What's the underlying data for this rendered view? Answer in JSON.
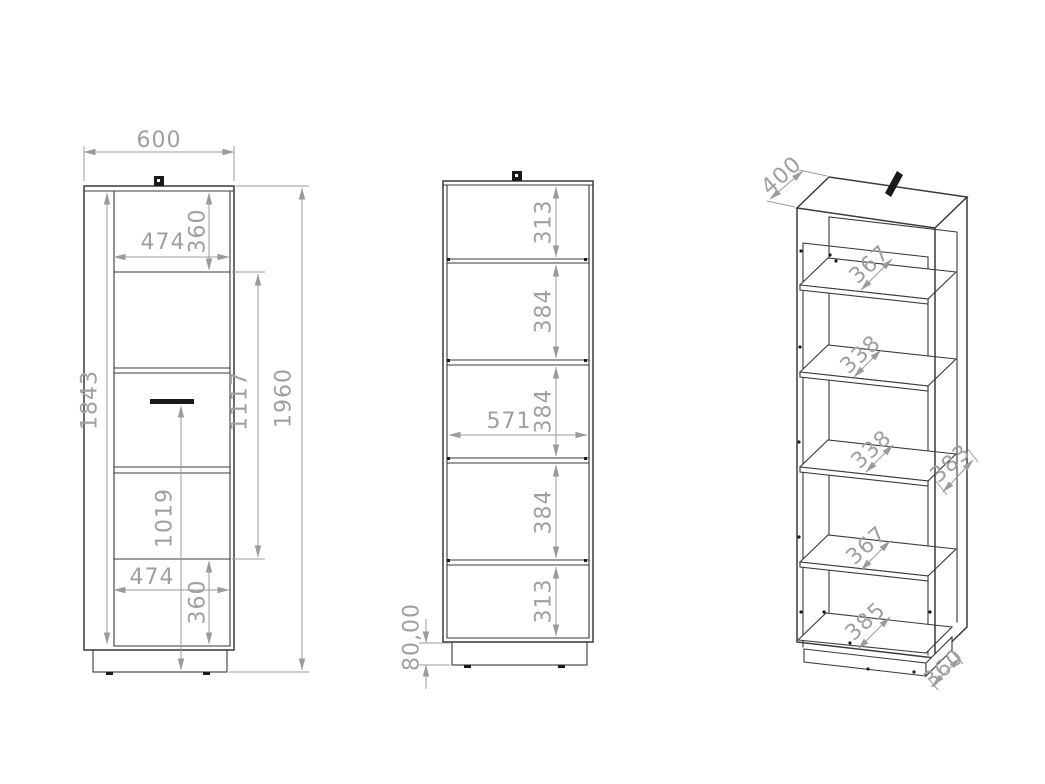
{
  "drawing": {
    "kind": "furniture technical drawing - tall cabinet, three views",
    "colors": {
      "background": "#ffffff",
      "object_line": "#3a3a3a",
      "dimension_line": "#9b9b9b",
      "dimension_text": "#a0a0a0",
      "fitting_marker": "#1a1a1a"
    },
    "front_view": {
      "width": "600",
      "door_panel_width_top": "474",
      "door_panel_height_top": "360",
      "door_height": "1843",
      "mid_section_height": "1117",
      "handle_height": "1019",
      "total_height": "1960",
      "door_panel_width_bottom": "474",
      "door_panel_height_bottom": "360"
    },
    "section_view": {
      "compartment_top": "313",
      "compartment_2": "384",
      "compartment_3": "384",
      "inner_width": "571",
      "compartment_4": "384",
      "compartment_bottom": "313",
      "plinth_height": "80,00"
    },
    "iso_view": {
      "top_depth": "400",
      "shelf1_depth": "367",
      "shelf2_depth": "338",
      "shelf3_depth": "338",
      "side_depth": "383",
      "shelf4_depth": "367",
      "bottom_depth": "385",
      "plinth_depth": "360"
    }
  }
}
